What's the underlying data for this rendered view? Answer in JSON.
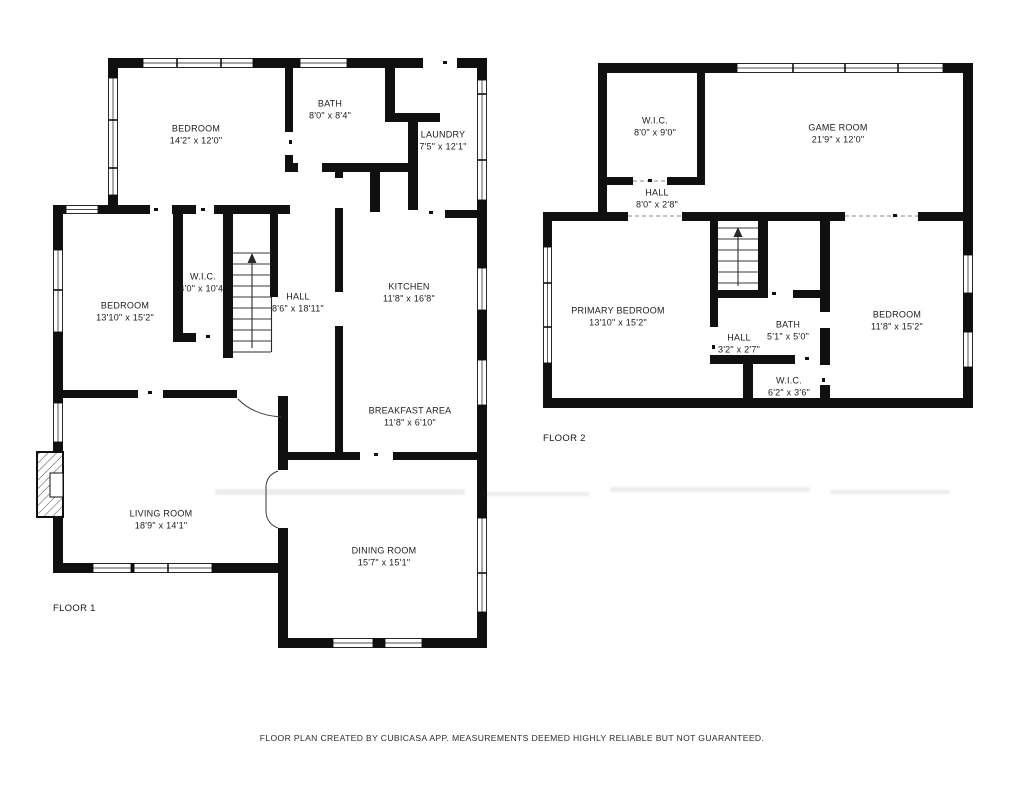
{
  "colors": {
    "wall": "#101010",
    "background": "#ffffff",
    "text": "#1c1c1c"
  },
  "floor1": {
    "label": "FLOOR 1",
    "rooms": [
      {
        "name": "BEDROOM",
        "dims": "14'2\" x 12'0\""
      },
      {
        "name": "BATH",
        "dims": "8'0\" x 8'4\""
      },
      {
        "name": "LAUNDRY",
        "dims": "7'5\" x 12'1\""
      },
      {
        "name": "W.I.C.",
        "dims": "4'0\" x 10'4\""
      },
      {
        "name": "BEDROOM",
        "dims": "13'10\" x 15'2\""
      },
      {
        "name": "HALL",
        "dims": "8'6\" x 18'11\""
      },
      {
        "name": "KITCHEN",
        "dims": "11'8\" x 16'8\""
      },
      {
        "name": "BREAKFAST AREA",
        "dims": "11'8\" x 6'10\""
      },
      {
        "name": "LIVING ROOM",
        "dims": "18'9\" x 14'1\""
      },
      {
        "name": "DINING ROOM",
        "dims": "15'7\" x 15'1\""
      }
    ]
  },
  "floor2": {
    "label": "FLOOR 2",
    "rooms": [
      {
        "name": "W.I.C.",
        "dims": "8'0\" x 9'0\""
      },
      {
        "name": "GAME ROOM",
        "dims": "21'9\" x 12'0\""
      },
      {
        "name": "HALL",
        "dims": "8'0\" x 2'8\""
      },
      {
        "name": "PRIMARY BEDROOM",
        "dims": "13'10\" x 15'2\""
      },
      {
        "name": "HALL",
        "dims": "3'2\" x 2'7\""
      },
      {
        "name": "BATH",
        "dims": "5'1\" x 5'0\""
      },
      {
        "name": "BEDROOM",
        "dims": "11'8\" x 15'2\""
      },
      {
        "name": "W.I.C.",
        "dims": "6'2\" x 3'6\""
      }
    ]
  },
  "footer": {
    "text": "FLOOR PLAN CREATED BY CUBICASA APP. MEASUREMENTS DEEMED HIGHLY RELIABLE BUT NOT GUARANTEED."
  }
}
